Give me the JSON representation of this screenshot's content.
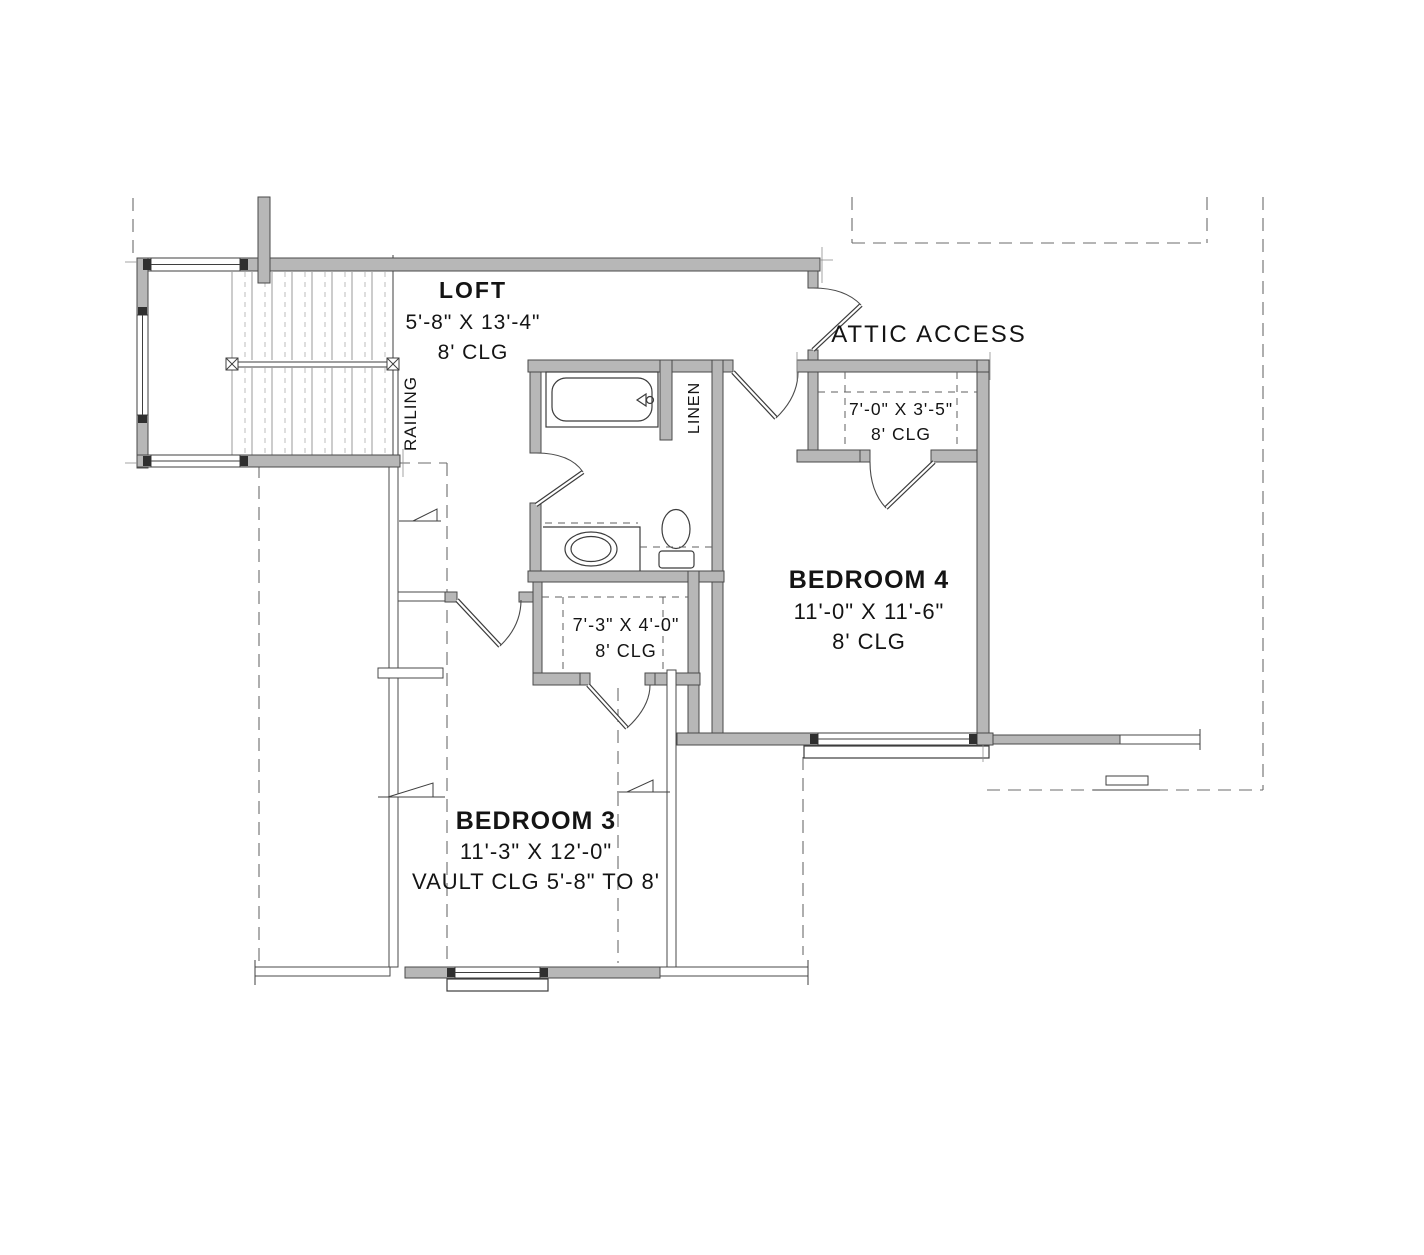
{
  "colors": {
    "background": "#ffffff",
    "wall_fill": "#b7b7b7",
    "wall_outline": "#4a4a4a",
    "dashed_line": "#6b6b6b",
    "text": "#141414"
  },
  "rooms": {
    "loft": {
      "name": "LOFT",
      "dims": "5'-8\" X 13'-4\"",
      "clg": "8' CLG"
    },
    "attic_access": {
      "label": "ATTIC ACCESS"
    },
    "attic_closet": {
      "dims": "7'-0\" X 3'-5\"",
      "clg": "8' CLG"
    },
    "bedroom4": {
      "name": "BEDROOM 4",
      "dims": "11'-0\" X 11'-6\"",
      "clg": "8' CLG"
    },
    "hall_closet": {
      "dims": "7'-3\" X 4'-0\"",
      "clg": "8' CLG"
    },
    "bedroom3": {
      "name": "BEDROOM 3",
      "dims": "11'-3\" X 12'-0\"",
      "clg": "VAULT CLG 5'-8\" TO 8'"
    }
  },
  "labels": {
    "railing": "RAILING",
    "linen": "LINEN"
  }
}
